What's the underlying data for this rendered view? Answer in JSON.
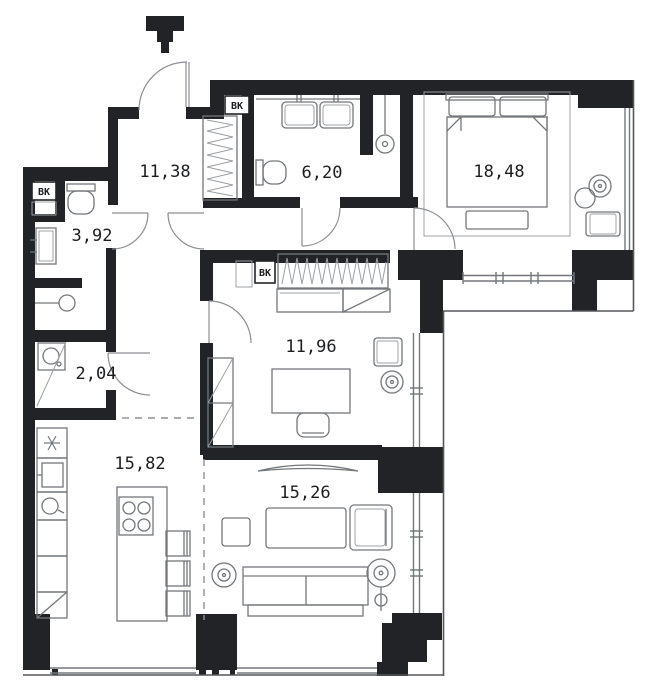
{
  "floor_plan": {
    "rooms": [
      {
        "name": "hallway",
        "area": "11,38"
      },
      {
        "name": "bathroom",
        "area": "6,20"
      },
      {
        "name": "bedroom",
        "area": "18,48"
      },
      {
        "name": "wc",
        "area": "3,92"
      },
      {
        "name": "office",
        "area": "11,96"
      },
      {
        "name": "storage",
        "area": "2,04"
      },
      {
        "name": "kitchen",
        "area": "15,82"
      },
      {
        "name": "living_room",
        "area": "15,26"
      }
    ],
    "vent_labels": {
      "wc_shaft": "ВК",
      "bathroom_shaft": "ВК",
      "office_shaft": "ВК"
    },
    "colors": {
      "wall": "#212326",
      "furniture_line": "#73777b",
      "background": "#ffffff"
    }
  }
}
